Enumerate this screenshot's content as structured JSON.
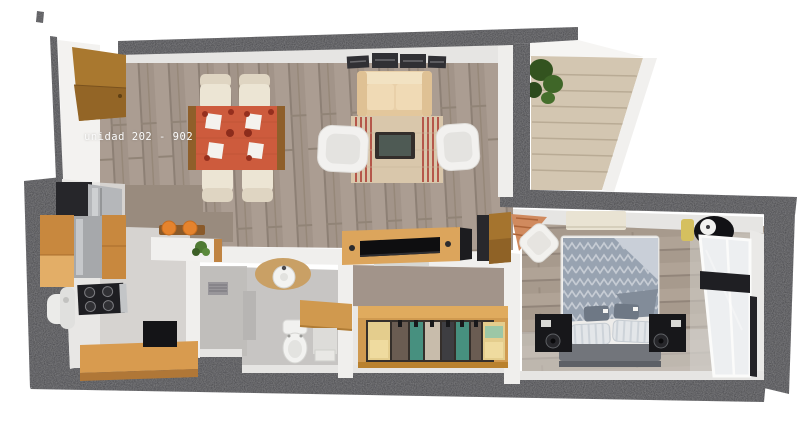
{
  "label": {
    "unit": "unidad 202 - 902"
  },
  "palette": {
    "outer_wall": "#3e3e43",
    "inner_wall_face": "#e6e5e3",
    "wood_floor": "#a29489",
    "bedroom_floor": "#a79a8d",
    "kitchen_floor": "#d6d3d0",
    "bathroom_floor": "#c7c5c3",
    "stairs": "#d3c6b1",
    "tablecloth_orange": "#cd5b3d",
    "wood_furniture": "#d09a50",
    "sofa_beige": "#e9d0a9",
    "bedding_gray_blue": "#98a3b1",
    "teal_clothes": "#47907f",
    "fruit_orange": "#e5832d",
    "plant_green": "#3f6628"
  },
  "semantics": {
    "rooms": [
      "entry",
      "kitchen",
      "dining-area",
      "living-room",
      "stair-hall",
      "bathroom",
      "walk-in-closet",
      "bedroom"
    ],
    "furniture": [
      "entry-door",
      "dining-table",
      "dining-chair",
      "bar-counter",
      "fridge",
      "stove",
      "kitchen-sink",
      "kitchen-cabinets",
      "kitchen-counter",
      "sofa",
      "armchair",
      "coffee-table",
      "rug",
      "wall-art",
      "tv-console",
      "stairs",
      "plant",
      "shower",
      "bathroom-sink",
      "toilet",
      "vanity-desk",
      "wardrobe",
      "bed",
      "nightstand-speaker",
      "accent-chair",
      "bench",
      "floor-lamp",
      "window"
    ]
  }
}
